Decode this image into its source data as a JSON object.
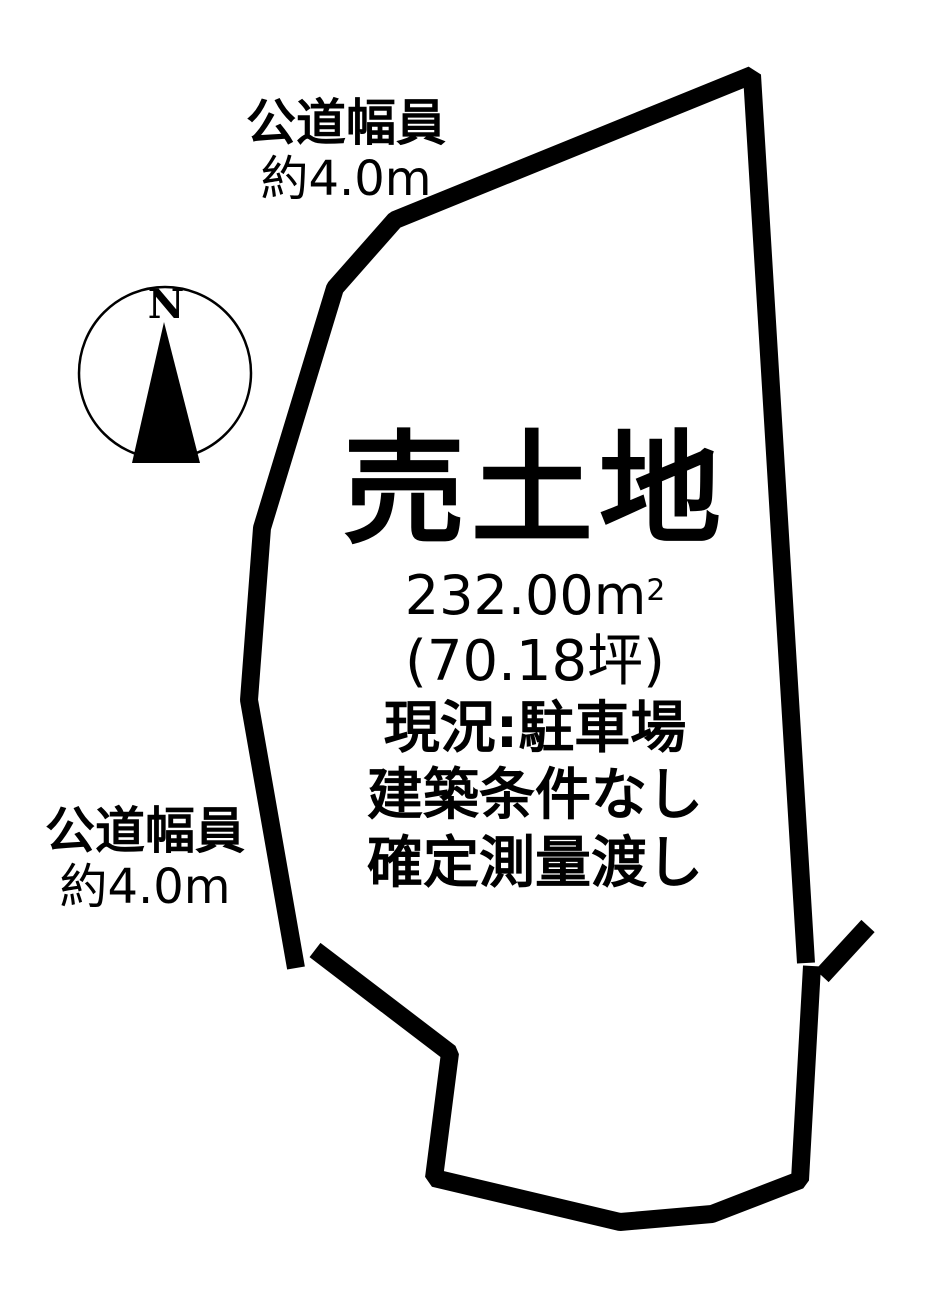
{
  "page": {
    "background": "#ffffff",
    "ink": "#000000"
  },
  "compass": {
    "label": "N"
  },
  "labels": {
    "road_top": {
      "line1": "公道幅員",
      "line2": "約4.0m"
    },
    "road_left": {
      "line1": "公道幅員",
      "line2": "約4.0m"
    }
  },
  "property": {
    "title": "売土地",
    "area": {
      "value": "232.00",
      "unit": "m",
      "sup": "2"
    },
    "area_tsubo": "(70.18坪)",
    "current_state": "現況:駐車場",
    "condition": "建築条件なし",
    "delivery": "確定測量渡し"
  }
}
